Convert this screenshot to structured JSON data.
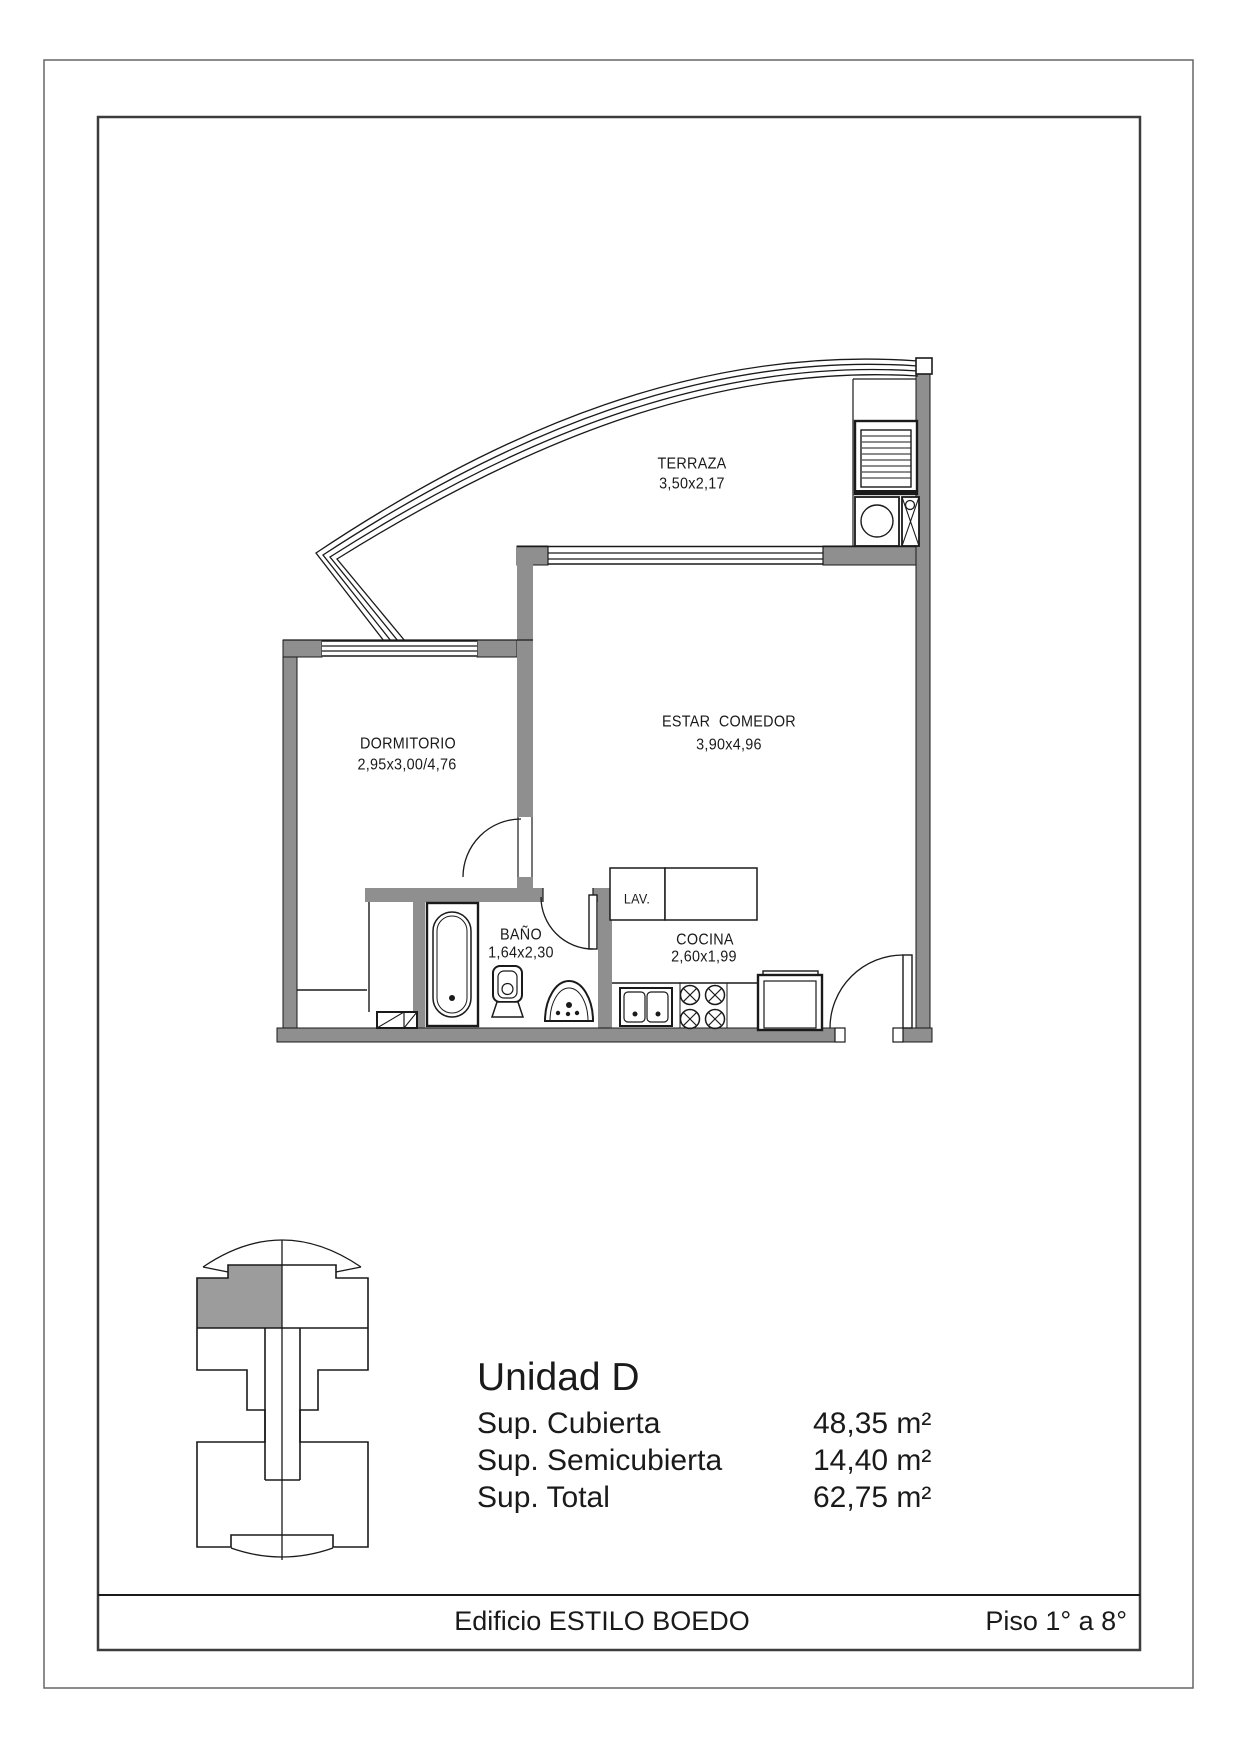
{
  "plan": {
    "rooms": {
      "terraza": {
        "name": "TERRAZA",
        "dims": "3,50x2,17"
      },
      "dormitorio": {
        "name": "DORMITORIO",
        "dims": "2,95x3,00/4,76"
      },
      "estar": {
        "name": "ESTAR  COMEDOR",
        "dims": "3,90x4,96"
      },
      "bano": {
        "name": "BAÑO",
        "dims": "1,64x2,30"
      },
      "cocina": {
        "name": "COCINA",
        "dims": "2,60x1,99"
      },
      "lavadero": {
        "name": "LAV."
      }
    }
  },
  "summary": {
    "title": "Unidad D",
    "rows": [
      {
        "label": "Sup. Cubierta",
        "value": "48,35 m²"
      },
      {
        "label": "Sup. Semicubierta",
        "value": "14,40 m²"
      },
      {
        "label": "Sup. Total",
        "value": "62,75 m²"
      }
    ]
  },
  "footer": {
    "building": "Edificio ESTILO BOEDO",
    "floors": "Piso 1° a 8°"
  },
  "colors": {
    "wall": "#8f8f8f",
    "keyplan_unit_fill": "#9c9c9c",
    "line": "#1a1a1a"
  }
}
